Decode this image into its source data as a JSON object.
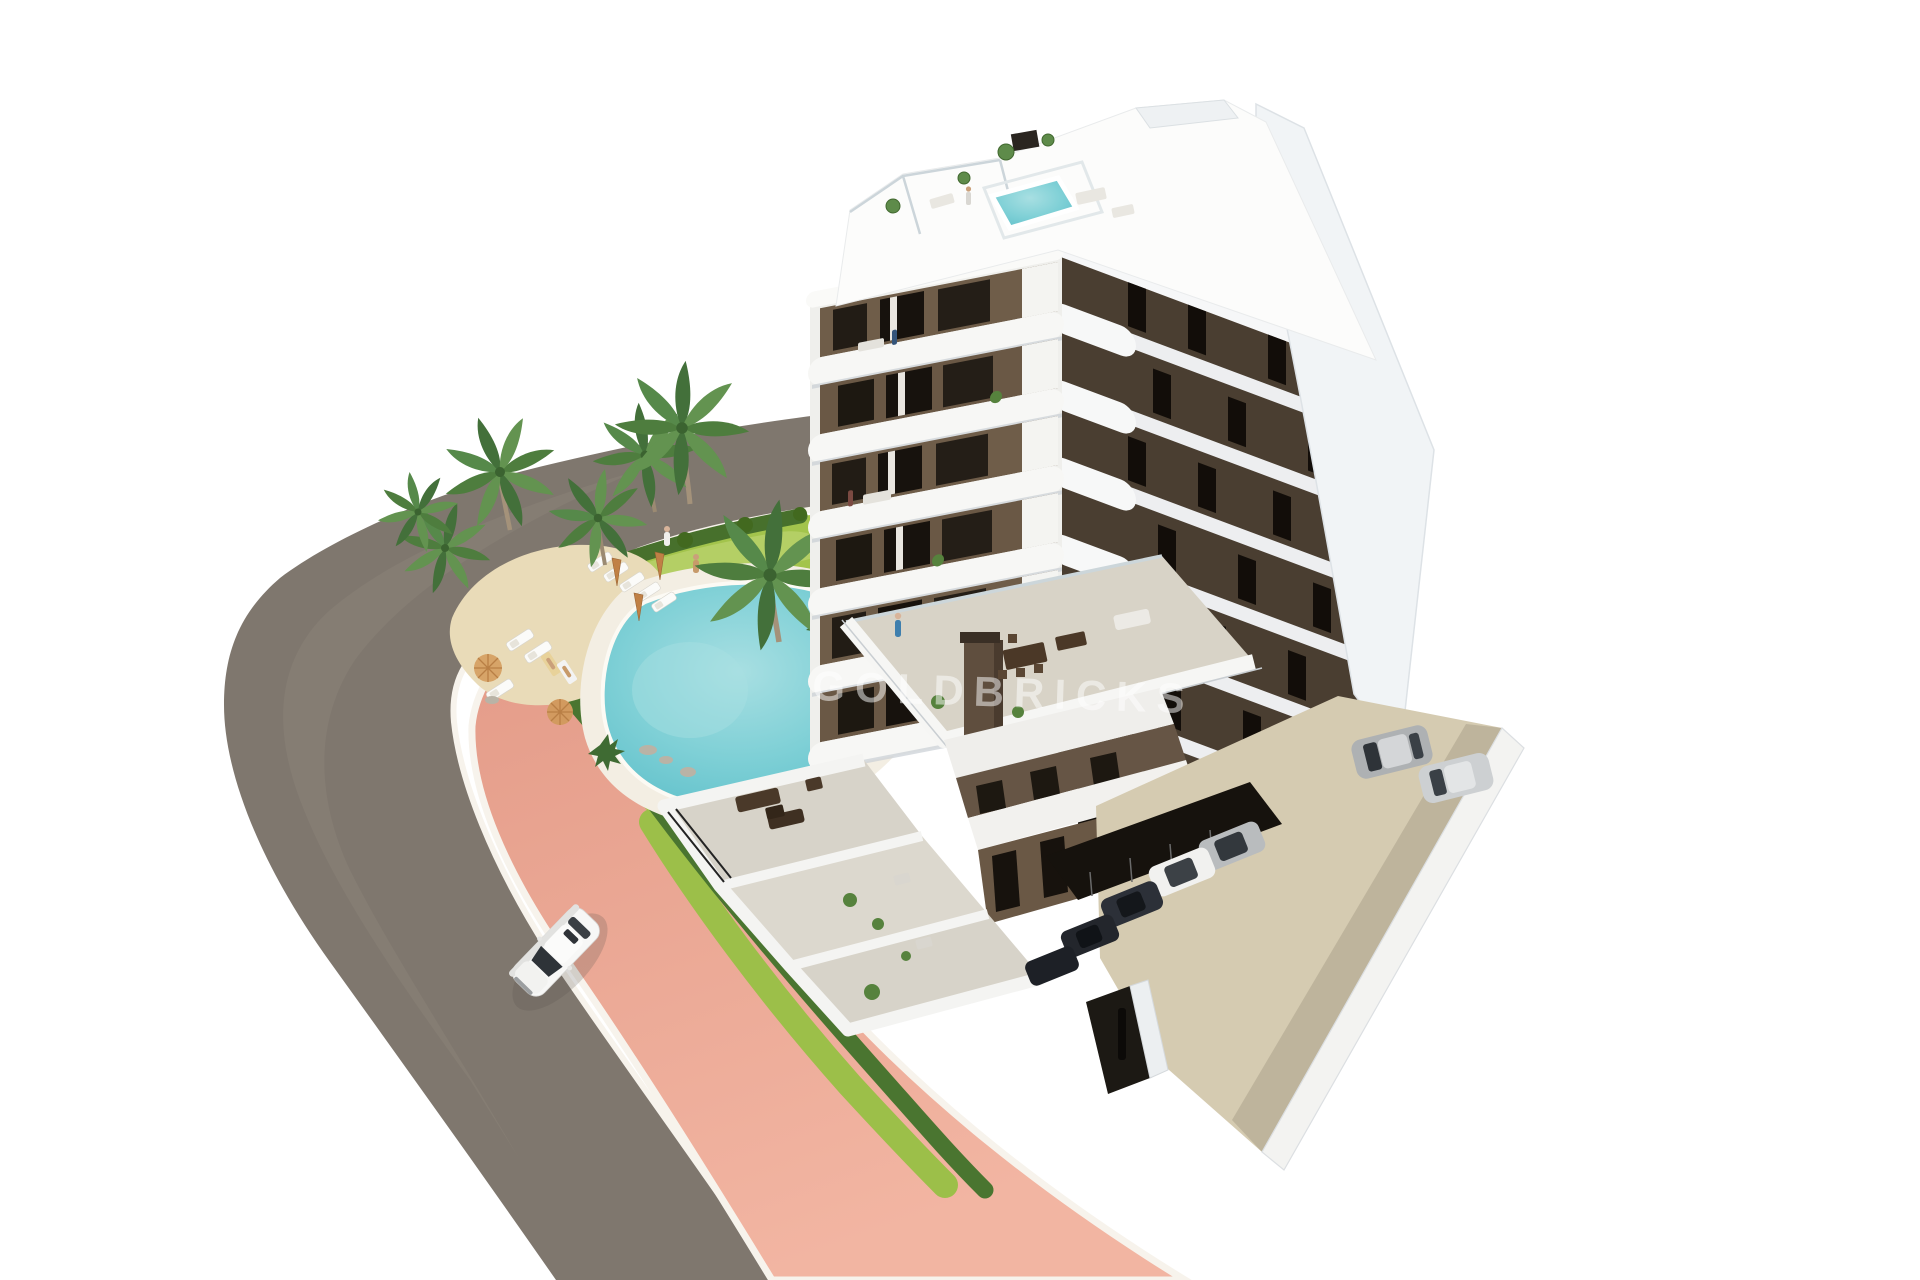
{
  "meta": {
    "type": "architectural-3d-render",
    "description": "Aerial 3D render of a modern seven-storey white-and-brown apartment building with a rooftop plunge pool, landscaped garden with free-form swimming pool, palm trees, sun loungers, a curved grey road with a salmon-pink sidewalk, a white car driving on the road and a walled parking area with parked cars, all on a pure white background."
  },
  "watermark": {
    "text": "GOLDBRICKS",
    "color": "#ffffff",
    "opacity": 0.5
  },
  "scene": {
    "background": "#ffffff",
    "building": {
      "label": "apartment building",
      "floors_visible": 7,
      "features": [
        "rooftop plunge pool",
        "roof terraces with plants",
        "rounded white balcony bands",
        "brown facade panels with tall dark windows",
        "large mid-level dining terrace",
        "ground-floor walled terraces"
      ]
    },
    "garden": {
      "label": "landscaped garden",
      "features": [
        "free-form turquoise pool with white deck",
        "lawn",
        "sand sunbathing area",
        "hedge borders",
        "rock and agave planting"
      ],
      "palm_trees": 7,
      "sun_loungers": 8,
      "parasols": 4
    },
    "road": {
      "label": "curved road",
      "sidewalk": "salmon pink with white curbs",
      "vehicle": "white sedan"
    },
    "parking": {
      "label": "walled parking area",
      "parked_cars": 7,
      "features": [
        "covered parking row",
        "entrance gate",
        "white perimeter wall"
      ]
    },
    "people_estimate": 9
  },
  "colors": {
    "road": "#7f776e",
    "road_light": "#8b837a",
    "sidewalk": "#e8a28e",
    "curb": "#f7f3ec",
    "hedge": "#4a7530",
    "hedge_dark": "#42691f",
    "grass": "#a3c44c",
    "grass_light": "#c3d97a",
    "sand": "#e9dbb8",
    "pool_deck": "#f3eee3",
    "pool_water": "#74cad2",
    "palm": "#4e7d3e",
    "palm_light": "#639350",
    "trunk": "#a4927a",
    "building_white": "#f6f6f4",
    "building_shade": "#c9cfd4",
    "facade_brown": "#6f5d49",
    "facade_brown_dark": "#4a3e31",
    "window_dark": "#1d1811",
    "east_wall": "#f1f4f6",
    "terrace_floor": "#d8d3c7",
    "parking_floor": "#d5cbb1",
    "carport_shadow": "#16120d",
    "car_white": "#f7f7f6",
    "car_silver": "#b9bcbe",
    "car_dark": "#2c3038",
    "umbrella": "#d29a5f",
    "person_blue": "#3f7fae"
  }
}
